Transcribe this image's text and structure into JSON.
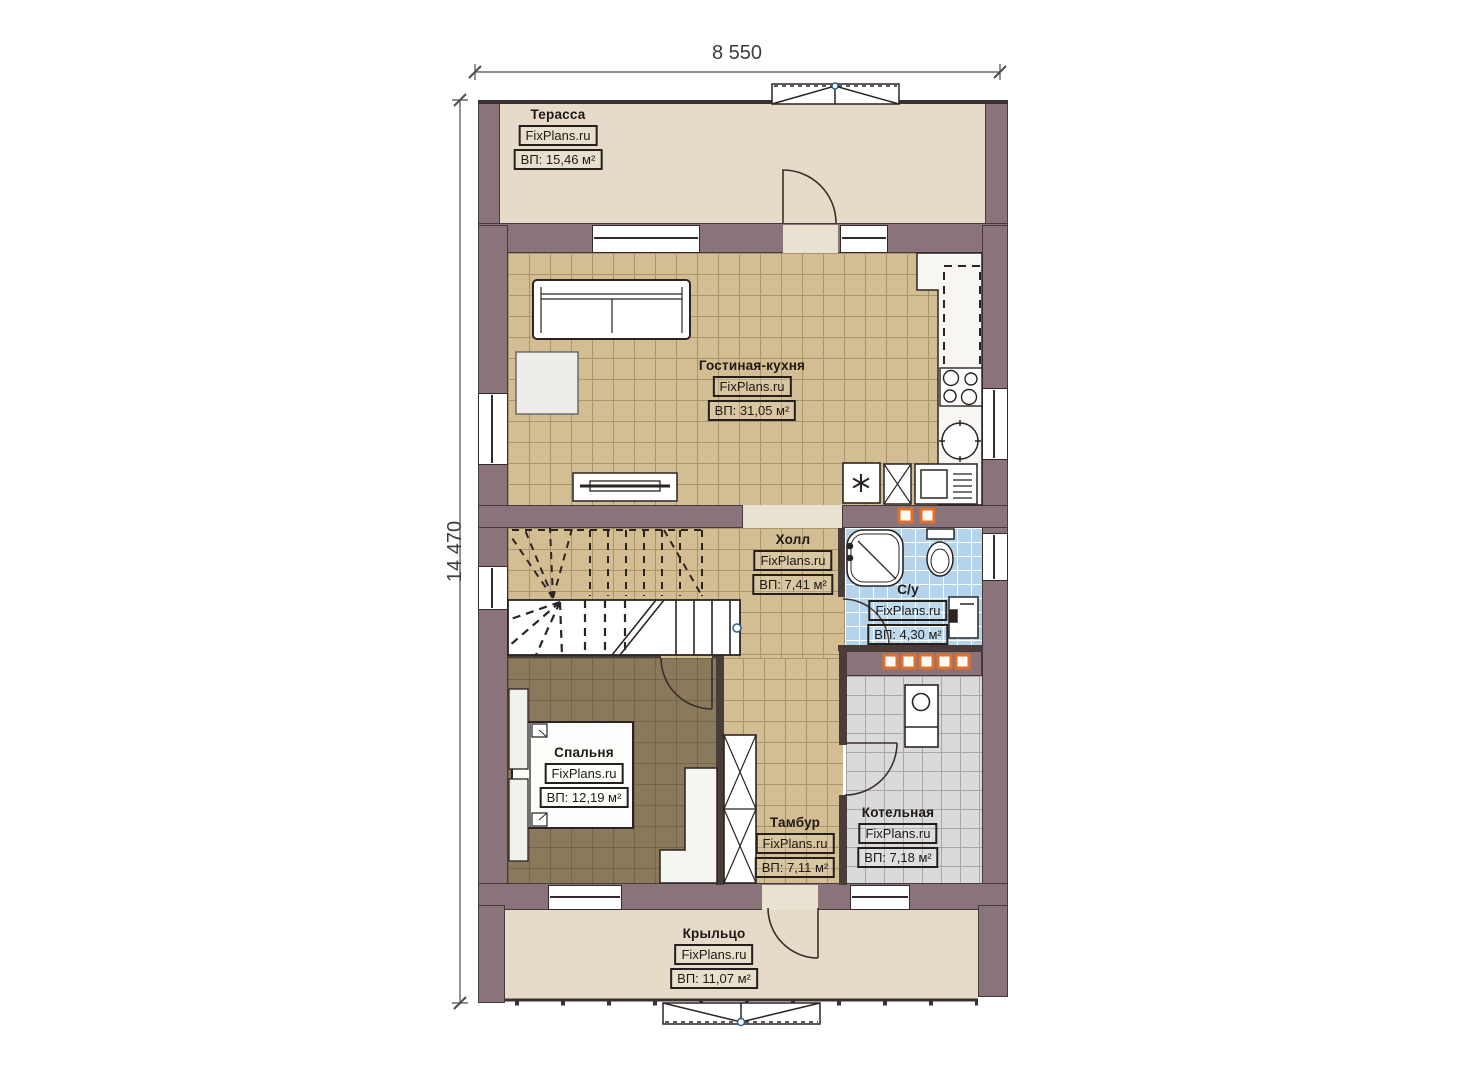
{
  "dimensions": {
    "width_label": "8 550",
    "height_label": "14 470"
  },
  "brand": "FixPlans.ru",
  "colors": {
    "wall": "#8a737a",
    "floor_tan": "#d3bd93",
    "floor_terrace": "#e5dbc8",
    "floor_bedroom": "#8a795b",
    "floor_bath": "#b5d3ea",
    "floor_boiler": "#dadada",
    "radiator_orange": "#e0702a",
    "marker_blue": "#2b5f8e"
  },
  "rooms": {
    "terrace": {
      "name": "Терасса",
      "brand": "FixPlans.ru",
      "area": "ВП: 15,46 м²"
    },
    "living": {
      "name": "Гостиная-кухня",
      "brand": "FixPlans.ru",
      "area": "ВП: 31,05 м²"
    },
    "hall": {
      "name": "Холл",
      "brand": "FixPlans.ru",
      "area": "ВП: 7,41 м²"
    },
    "bathroom": {
      "name": "С/у",
      "brand": "FixPlans.ru",
      "area": "ВП: 4,30 м²"
    },
    "bedroom": {
      "name": "Спальня",
      "brand": "FixPlans.ru",
      "area": "ВП: 12,19 м²"
    },
    "vestibule": {
      "name": "Тамбур",
      "brand": "FixPlans.ru",
      "area": "ВП: 7,11 м²"
    },
    "boiler": {
      "name": "Котельная",
      "brand": "FixPlans.ru",
      "area": "ВП: 7,18 м²"
    },
    "porch": {
      "name": "Крыльцо",
      "brand": "FixPlans.ru",
      "area": "ВП: 11,07 м²"
    }
  }
}
